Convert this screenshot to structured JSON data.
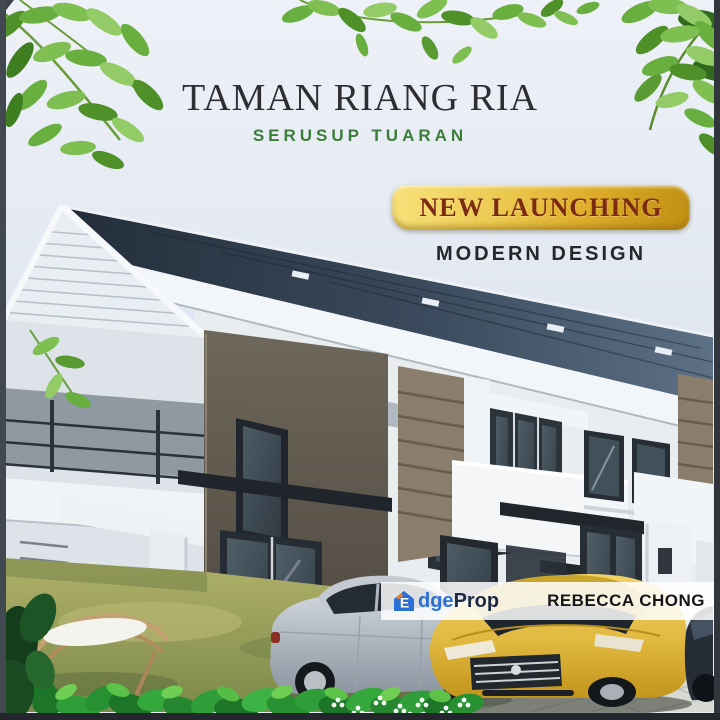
{
  "poster": {
    "title": "TAMAN RIANG RIA",
    "subtitle": "SERUSUP TUARAN",
    "ribbon_label": "NEW LAUNCHING",
    "tagline": "MODERN DESIGN"
  },
  "watermark": {
    "brand_icon_letter": "E",
    "brand_blue_text": "dge",
    "brand_dark_text": "Prop",
    "agent_name": "REBECCA CHONG"
  },
  "scene_description": {
    "subject": "two-storey-modern-terrace-house-3d-rendering",
    "foreground": "lawn, hammock chair, hedge with white flowers, silver sedan, gold sedan, dark car",
    "decor": "green leaves in top corners"
  },
  "colors": {
    "title_dark": "#2e2d33",
    "accent_green": "#3c7d39",
    "ribbon_text": "#7c2a12",
    "ribbon_gold_light": "#f8e27c",
    "ribbon_gold_dark": "#c08e12",
    "tagline_dark": "#26262b",
    "brand_blue": "#2a6fd6",
    "brand_navy": "#1d2b45",
    "brand_orange": "#f4791f",
    "agent_dark": "#15161a",
    "roof_dark": "#232d39",
    "panel_taupe": "#6e675b",
    "panel_brown": "#8b7d6c",
    "grass_olive": "#9fa55c",
    "hedge_green": "#2f9e38",
    "car_gold": "#e0b83e",
    "car_silver": "#b3bcc4",
    "frame_dark": "#31363d"
  }
}
